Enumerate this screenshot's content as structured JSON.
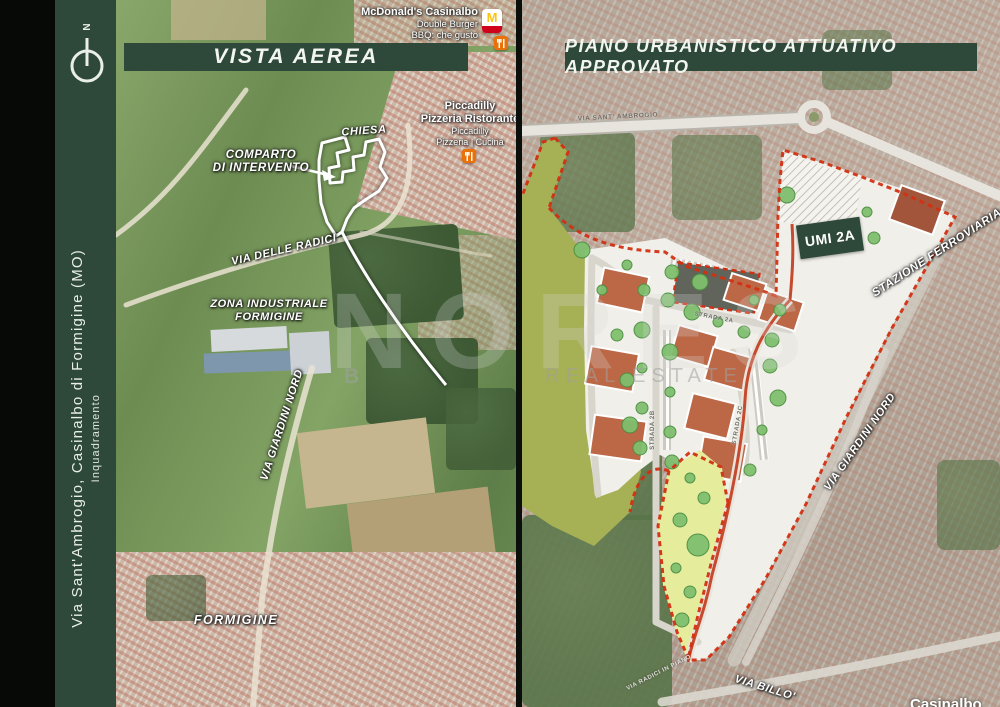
{
  "slide": {
    "sidebar": {
      "north_label": "N",
      "title": "Via Sant'Ambrogio, Casinalbo di Formigine (MO)",
      "subtitle": "Inquadramento"
    },
    "left_map": {
      "title": "VISTA AEREA",
      "pois": {
        "mcdonalds_name": "McDonald's Casinalbo",
        "mcdonalds_sub1": "Double Burger",
        "mcdonalds_sub2": "BBQ: che gusto",
        "mcdonalds_monogram": "M",
        "piccadilly_name": "Piccadilly",
        "piccadilly_name2": "Pizzeria Ristorante",
        "piccadilly_sub1": "Piccadilly",
        "piccadilly_sub2": "Pizzeria | Cucina"
      },
      "labels": {
        "chiesa": "CHIESA",
        "comparto_line1": "COMPARTO",
        "comparto_line2": "DI INTERVENTO",
        "via_delle_radici": "VIA DELLE RADICI",
        "zona_industriale_line1": "ZONA INDUSTRIALE",
        "zona_industriale_line2": "FORMIGINE",
        "via_giardini_nord": "VIA GIARDINI NORD",
        "formigine": "FORMIGINE"
      }
    },
    "right_map": {
      "title": "PIANO URBANISTICO ATTUATIVO APPROVATO",
      "umi_label": "UMI 2A",
      "road_labels": {
        "via_sant_ambrogio": "VIA SANT' AMBROGIO",
        "strada_2a": "STRADA 2A",
        "strada_2b": "STRADA 2B",
        "strada_2c": "STRADA 2C",
        "via_radici_in_piano": "VIA RADICI IN PIANO",
        "stazione_ferroviaria": "STAZIONE FERROVIARIA",
        "via_giardini_nord": "VIA GIARDINI NORD",
        "via_billo": "VIA BILLO'",
        "place_partial": "Casinalbo"
      }
    },
    "watermark": {
      "brand": "NORES",
      "initial": "B",
      "tagline": "REAL ESTATE"
    },
    "colors": {
      "panel_green": "#2e4839",
      "boundary_red": "#d23012",
      "olive": "#a6b055",
      "park_yellow": "#e5ec9c",
      "building_terracotta": "#bc6847",
      "mcdonalds_yellow": "#ffc20e",
      "poi_orange": "#e8710a"
    }
  }
}
